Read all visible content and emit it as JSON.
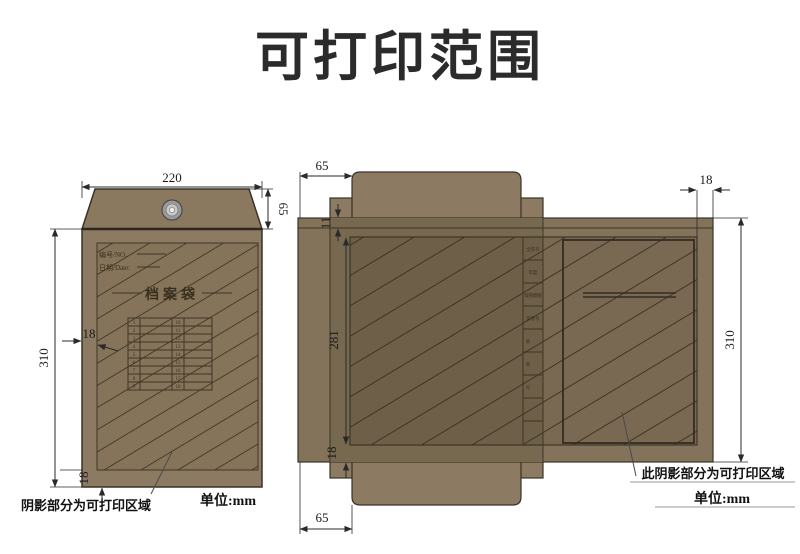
{
  "title": "可打印范围",
  "left": {
    "dims": {
      "width": "220",
      "flap_height": "65",
      "height": "310",
      "margin_left": "18",
      "margin_bottom": "18"
    },
    "envelope": {
      "no_label": "编号/NO.",
      "date_label": "日期/Date:",
      "bag_title": "档案袋",
      "table_left_numbers": [
        "1",
        "2",
        "3",
        "4",
        "5",
        "6",
        "7",
        "8",
        "9"
      ],
      "table_right_numbers": [
        "10",
        "11",
        "12",
        "13",
        "14",
        "15",
        "16",
        "17",
        "18"
      ]
    },
    "note": "阴影部分为可打印区域",
    "unit": "单位:mm"
  },
  "right": {
    "dims": {
      "flap_top": "65",
      "flap_bottom": "65",
      "top_inset": "11",
      "print_height": "281",
      "margin_bottom": "18",
      "margin_right": "18",
      "height": "310"
    },
    "spine_labels": [
      "全宗号",
      "年度",
      "保管期限",
      "案卷号",
      "第",
      "卷",
      "号"
    ],
    "note": "此阴影部分为可打印区域",
    "unit": "单位:mm"
  },
  "colors": {
    "paper": "#8C7B62",
    "paper_flap": "#8A795F",
    "paper_band": "#84735B",
    "paper_overlap": "#776850",
    "hatch_base": "#857459",
    "hatch_line": "#3E3526",
    "outline": "#3A3228",
    "title_color": "#2B2B2B"
  }
}
